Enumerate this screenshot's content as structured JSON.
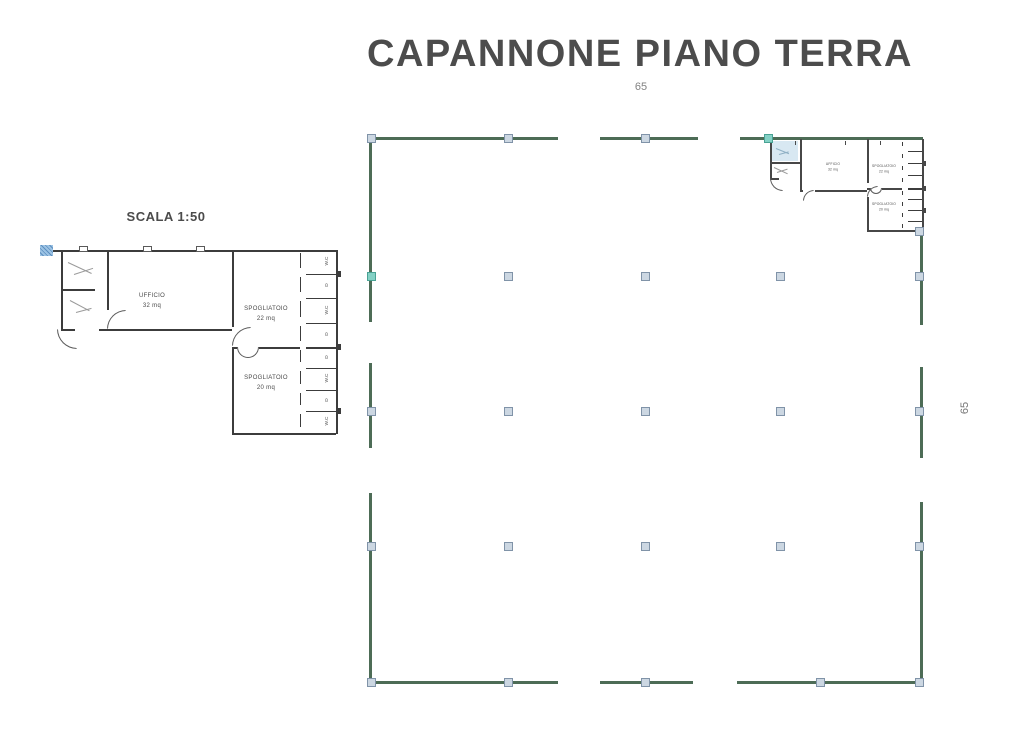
{
  "header": {
    "title": "CAPANNONE PIANO TERRA",
    "page_number": "65"
  },
  "side": {
    "page_number": "65"
  },
  "detail": {
    "scale_label": "SCALA 1:50",
    "rooms": [
      {
        "name": "UFFICIO",
        "area": "32 mq"
      },
      {
        "name": "SPOGLIATOIO",
        "area": "22 mq"
      },
      {
        "name": "SPOGLIATOIO",
        "area": "20 mq"
      }
    ],
    "wc_stalls": [
      "W.C",
      "D",
      "W.C",
      "D",
      "D",
      "W.C",
      "D",
      "W.C"
    ]
  },
  "warehouse": {
    "annex_rooms": [
      {
        "name": "UFFICIO",
        "area": "32 mq"
      },
      {
        "name": "SPOGLIATOIO",
        "area": "22 mq"
      },
      {
        "name": "SPOGLIATOIO",
        "area": "20 mq"
      }
    ],
    "colors": {
      "wall_green": "#4d6c56",
      "column_fill": "#ccd7e2",
      "column_border": "#8093a8",
      "column_teal": "#84d1c5",
      "drawing_line": "#3c3c3c"
    }
  }
}
